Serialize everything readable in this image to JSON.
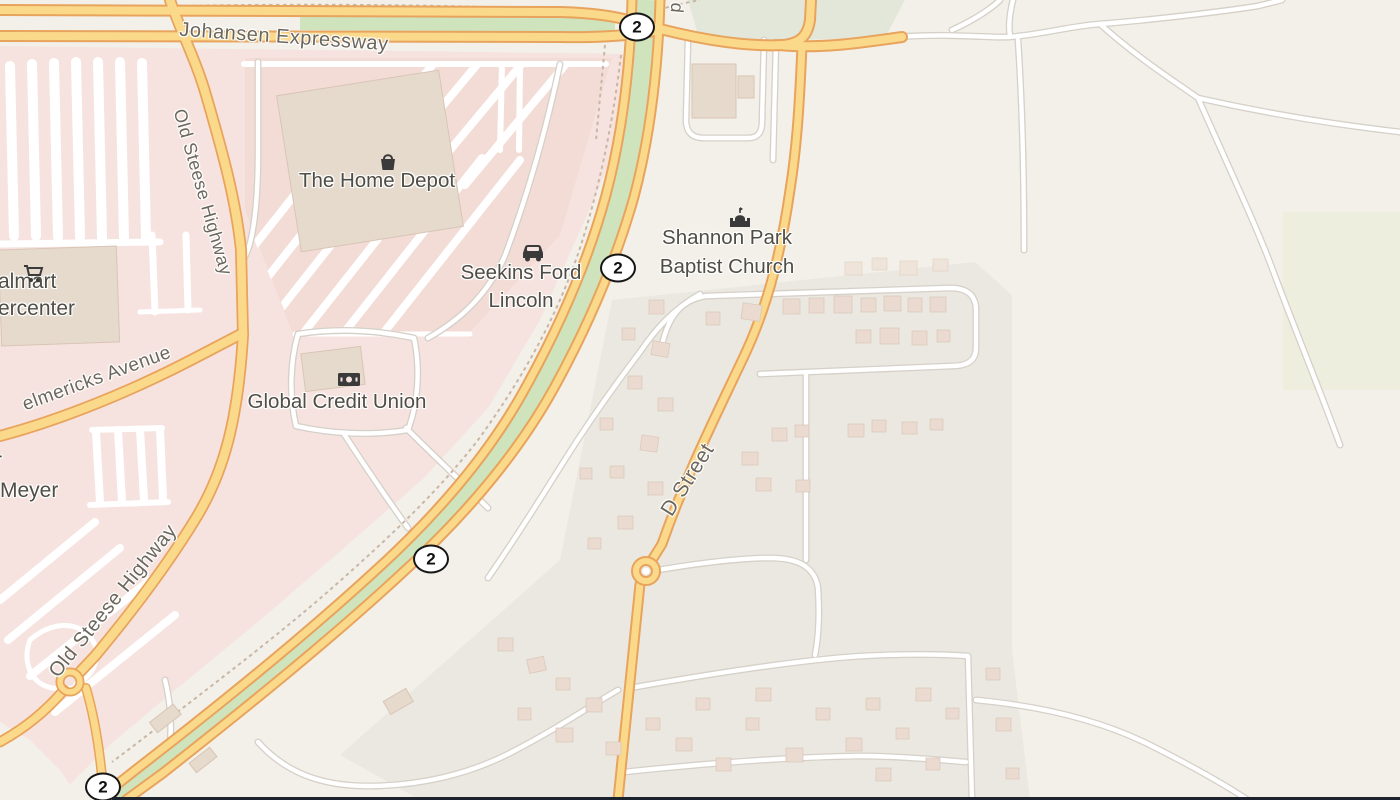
{
  "map": {
    "attribution_style": "openstreetmap-raster-tiles",
    "labels": {
      "johansen": "Johansen Expressway",
      "old_steese_top": "Old Steese Highway",
      "old_steese_bottom": "Old Steese Highway",
      "helmericks": "elmericks Avenue",
      "walmart_line1": "almart",
      "walmart_line2": "ercenter",
      "home_depot": "The Home Depot",
      "seekins_line1": "Seekins Ford",
      "seekins_line2": "Lincoln",
      "global_cu": "Global Credit Union",
      "church_line1": "Shannon Park",
      "church_line2": "Baptist Church",
      "meyer": "Meyer",
      "meyer_fragment": "r",
      "d_street": "D Street",
      "top_edge_fragment": "d"
    },
    "shields": [
      "2",
      "2",
      "2",
      "2"
    ],
    "icons": {
      "walmart": "cart-icon",
      "home_depot": "basket-icon",
      "seekins": "car-icon",
      "global_cu": "banknote-icon",
      "church": "church-icon"
    },
    "colors": {
      "background": "#f3f0e9",
      "retail_pink": "#f6e3df",
      "retail_pink_deep": "#f3dcd6",
      "residential": "#ebe8e1",
      "road_yellow": "#fbd98b",
      "road_yellow_casing": "#e8a35c",
      "road_white": "#ffffff",
      "road_white_casing": "#d5d0c8",
      "green_median": "#cfe4bd",
      "green_patch": "#e3e7da",
      "label_text": "#4e4d46",
      "shield_border": "#161616",
      "bottom_strip": "#1d232e"
    }
  }
}
